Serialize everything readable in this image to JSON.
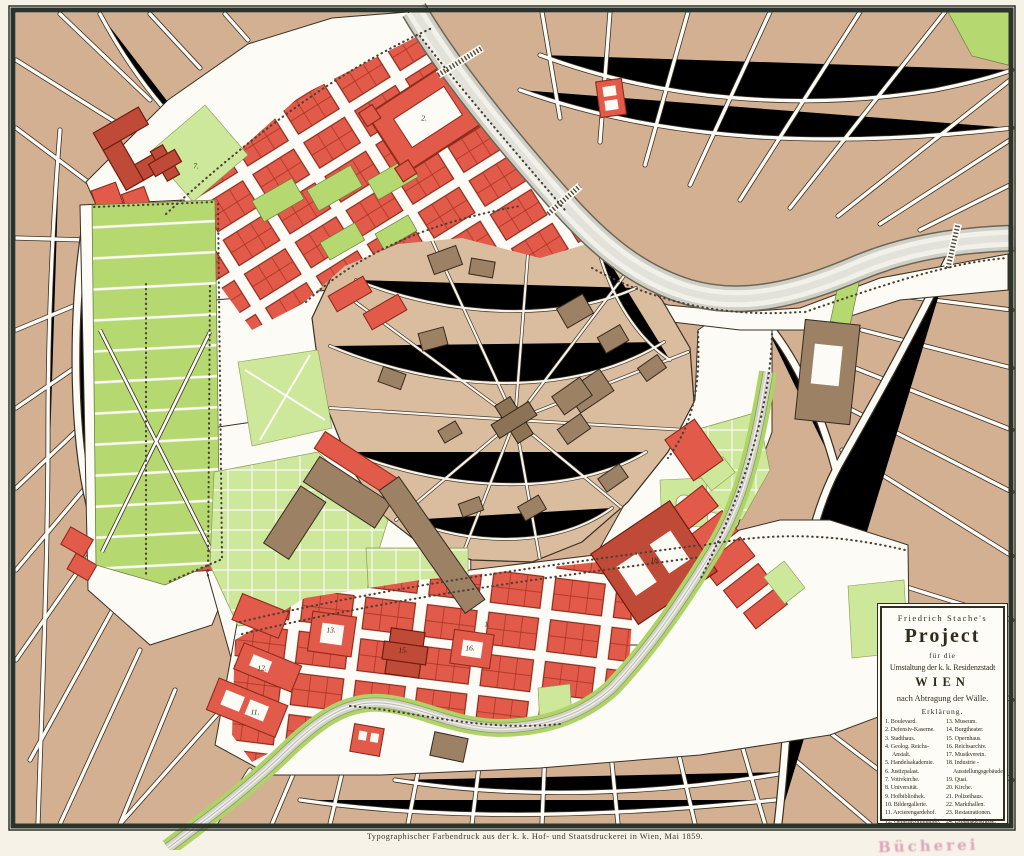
{
  "map": {
    "cartouche": {
      "author_line": "Friedrich Stache's",
      "title": "Project",
      "subtitle1": "für die",
      "subtitle2": "Umstaltung der k. k. Residenzstadt",
      "city": "WIEN",
      "subtitle3": "nach Abtragung der Wälle.",
      "legend_heading": "Erklärung.",
      "legend_left": [
        "1. Boulevard.",
        "2. Defensiv-Kaserne.",
        "3. Stadthaus.",
        "4. Geolog. Reichs-Anstalt.",
        "5. Handelsakademie.",
        "6. Justizpalast.",
        "7. Votivkirche.",
        "8. Universität.",
        "9. Hofbibliothek.",
        "10. Bildergallerie.",
        "11. Arcierengardehof.",
        "12. Generalcommando."
      ],
      "legend_right": [
        "13. Museum.",
        "14. Burgtheater.",
        "15. Opernhaus.",
        "16. Reichsarchiv.",
        "17. Musikverein.",
        "18. Industrie - Ausstellungsgebäude.",
        "19. Quai.",
        "20. Kirche.",
        "21. Polizeihaus.",
        "22. Markthallen.",
        "23. Restaurationen.",
        "24. Esplanadestrasse."
      ]
    },
    "caption": "Typographischer Farbendruck aus der k. k. Hof- und Staatsdruckerei in Wien, Mai 1859.",
    "stamp": "Bücherei",
    "plot_numbers": [
      {
        "label": "1.",
        "x": 487,
        "y": 624
      },
      {
        "label": "2.",
        "x": 424,
        "y": 118
      },
      {
        "label": "7.",
        "x": 196,
        "y": 166
      },
      {
        "label": "11.",
        "x": 255,
        "y": 712
      },
      {
        "label": "12.",
        "x": 262,
        "y": 668
      },
      {
        "label": "13.",
        "x": 331,
        "y": 630
      },
      {
        "label": "15.",
        "x": 403,
        "y": 650
      },
      {
        "label": "16.",
        "x": 470,
        "y": 648
      },
      {
        "label": "18.",
        "x": 655,
        "y": 560
      }
    ],
    "colors": {
      "paper": "#f6f2e8",
      "frame": "#2b332a",
      "street_white": "#fcfbf6",
      "suburb_tan": "#d3b092",
      "inner_tan": "#dabc9e",
      "block_outline": "#3a3024",
      "red_block": "#e25a49",
      "red_dark": "#bf4a38",
      "red_line": "#a33122",
      "green": "#b6d870",
      "green_light": "#cde79b",
      "gray_building": "#9d8165",
      "river": "#f1f1ea",
      "river_edge": "#c6c6bd",
      "stamp_pink": "#c96496"
    }
  }
}
